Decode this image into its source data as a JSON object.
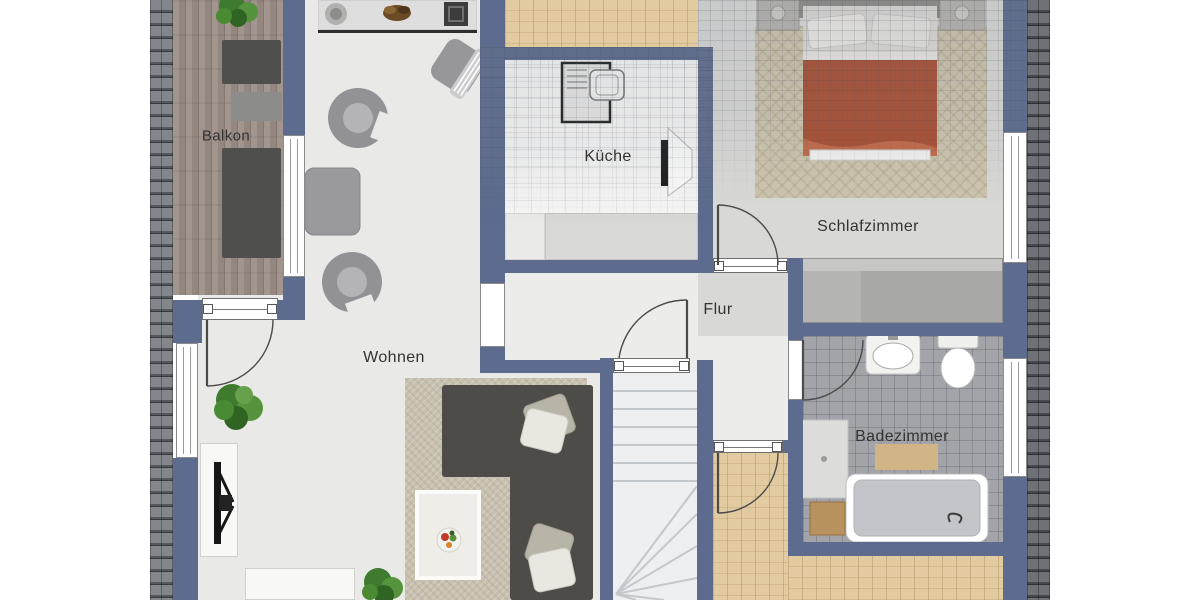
{
  "app": {
    "type": "floor-plan-viewer",
    "floor": "attic-storey"
  },
  "plan": {
    "rooms": [
      {
        "id": "balkon",
        "label": "Balkon"
      },
      {
        "id": "wohnen",
        "label": "Wohnen"
      },
      {
        "id": "kueche",
        "label": "Küche"
      },
      {
        "id": "flur",
        "label": "Flur"
      },
      {
        "id": "schlafzimmer",
        "label": "Schlafzimmer"
      },
      {
        "id": "badezimmer",
        "label": "Badezimmer"
      }
    ],
    "colors": {
      "wall": "#5c6b8e",
      "floor_light": "#e9e9e8",
      "floor_flur": "#ececeb",
      "floor_bedroom": "#d8d8d6",
      "floor_bath": "#a2a4a9",
      "roof_shingle_dark": "#63666b",
      "roof_tan": "#ddc59c",
      "deck_wood": "#9a8d86",
      "bed_duvet": "#a84f33",
      "sofa": "#4e4c49",
      "label_text": "#333333"
    }
  }
}
